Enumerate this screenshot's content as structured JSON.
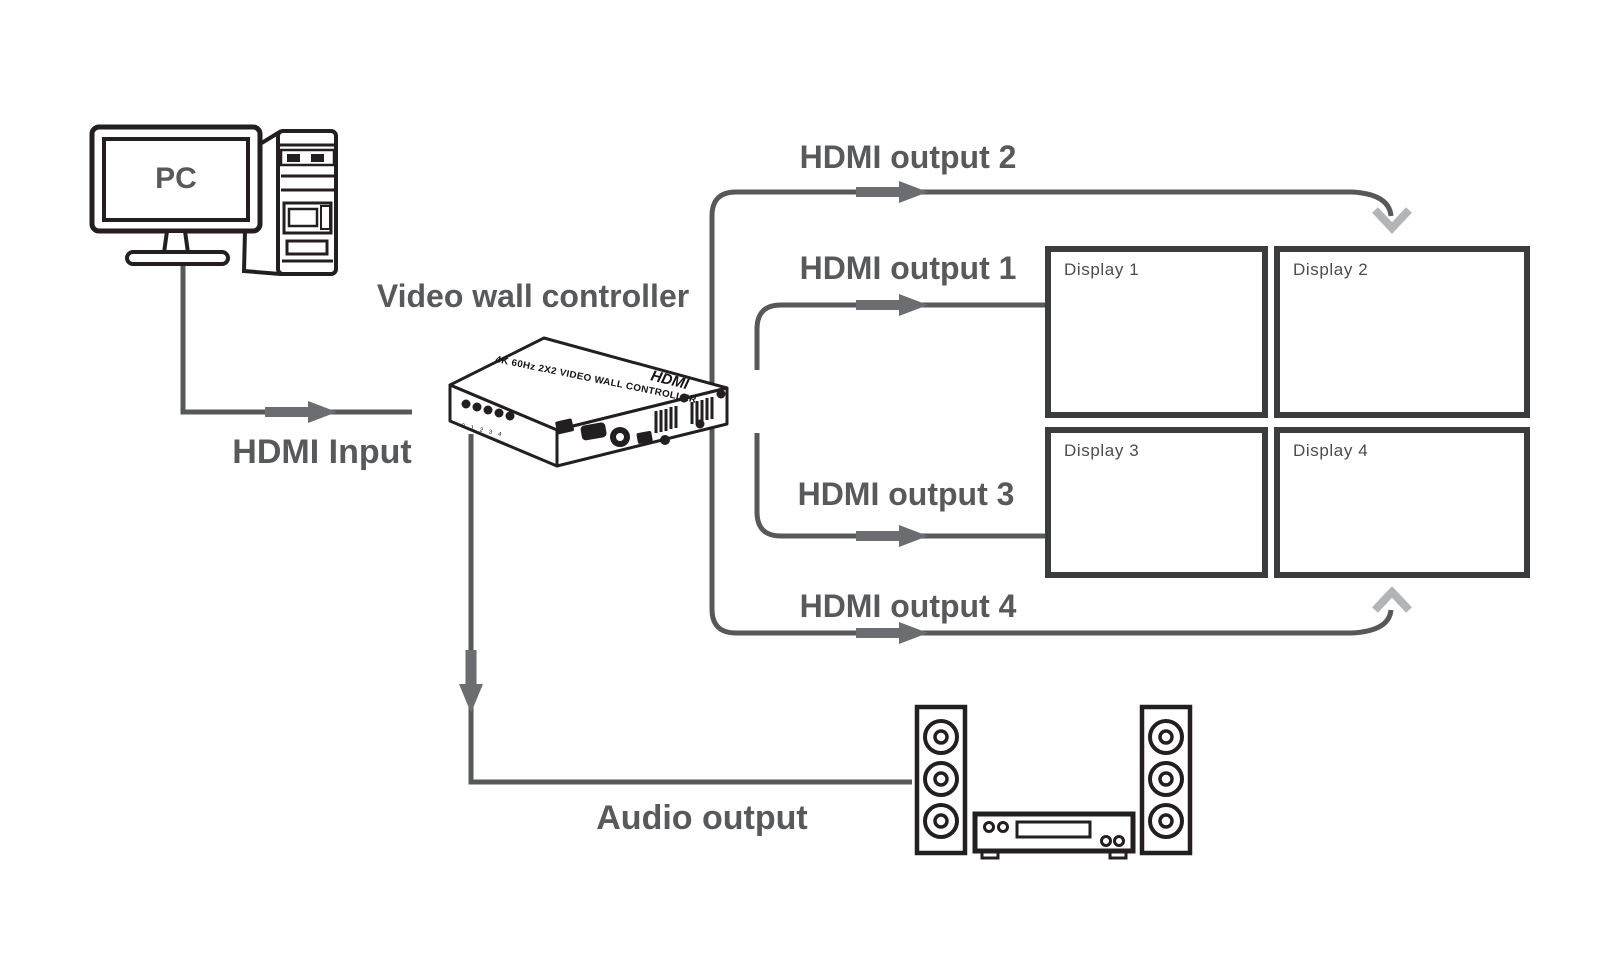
{
  "colors": {
    "background": "#ffffff",
    "line_art": "#231f20",
    "cable": "#57585a",
    "arrow": "#6c6d70",
    "chevron": "#b3b4b6",
    "label_text": "#58595b",
    "display_border": "#3b3c3e",
    "display_label_text": "#4b4c4e"
  },
  "labels": {
    "pc": "PC",
    "controller": "Video wall controller",
    "hdmi_input": "HDMI Input",
    "audio_output": "Audio output"
  },
  "outputs": [
    {
      "label": "HDMI output 1"
    },
    {
      "label": "HDMI output 2"
    },
    {
      "label": "HDMI output 3"
    },
    {
      "label": "HDMI output 4"
    }
  ],
  "displays": [
    {
      "label": "Display 1"
    },
    {
      "label": "Display 2"
    },
    {
      "label": "Display 3"
    },
    {
      "label": "Display 4"
    }
  ],
  "device": {
    "top_text": "4K 60Hz 2X2 VIDEO WALL CONTROLLER",
    "logo": "HDMI",
    "led_labels": "0 1 2 3 4"
  }
}
